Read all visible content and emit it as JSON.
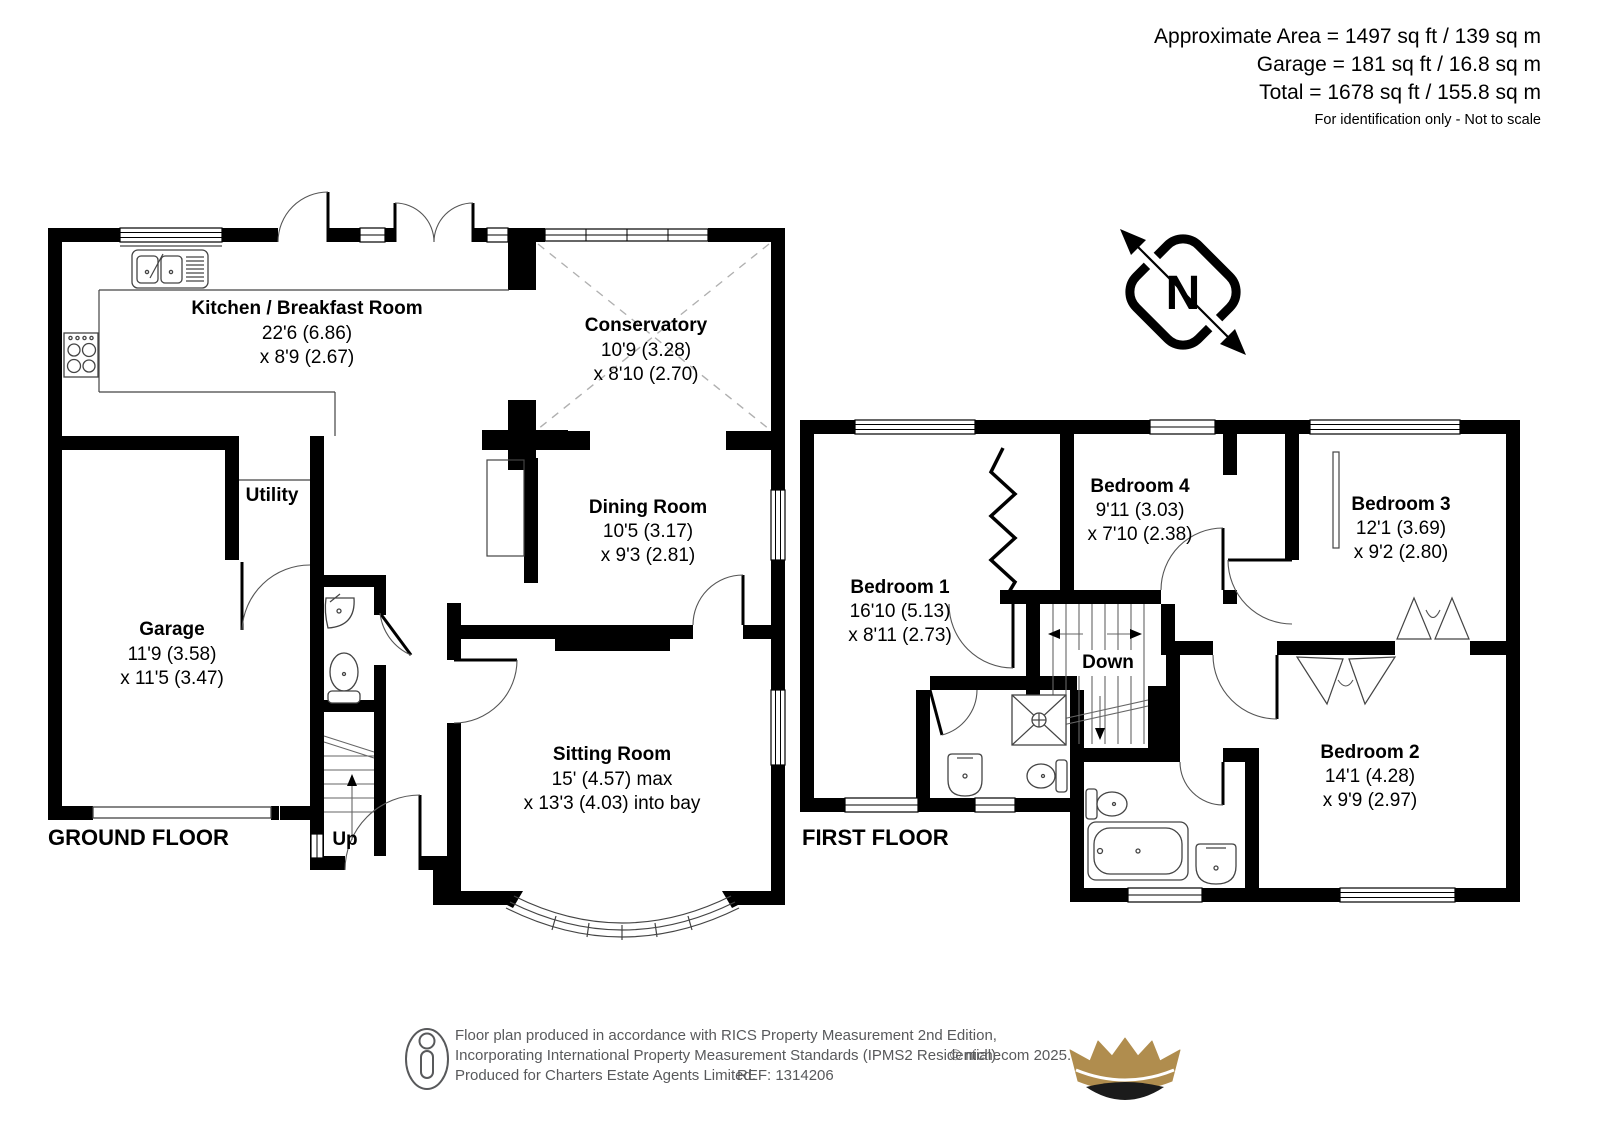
{
  "header": {
    "line1": "Approximate Area = 1497 sq ft / 139 sq m",
    "line2": "Garage = 181 sq ft / 16.8 sq m",
    "line3": "Total = 1678 sq ft / 155.8 sq m",
    "note": "For identification only - Not to scale"
  },
  "compass": {
    "label": "N"
  },
  "ground_floor": {
    "label": "GROUND FLOOR",
    "stairs_label": "Up",
    "rooms": {
      "kitchen": {
        "name": "Kitchen / Breakfast Room",
        "dim1": "22'6 (6.86)",
        "dim2": "x 8'9 (2.67)"
      },
      "conservatory": {
        "name": "Conservatory",
        "dim1": "10'9 (3.28)",
        "dim2": "x 8'10 (2.70)"
      },
      "dining_room": {
        "name": "Dining Room",
        "dim1": "10'5 (3.17)",
        "dim2": "x 9'3 (2.81)"
      },
      "sitting_room": {
        "name": "Sitting Room",
        "dim1": "15' (4.57) max",
        "dim2": "x 13'3 (4.03) into bay"
      },
      "utility": {
        "name": "Utility"
      },
      "garage": {
        "name": "Garage",
        "dim1": "11'9 (3.58)",
        "dim2": "x 11'5 (3.47)"
      }
    }
  },
  "first_floor": {
    "label": "FIRST FLOOR",
    "stairs_label": "Down",
    "rooms": {
      "bedroom1": {
        "name": "Bedroom 1",
        "dim1": "16'10 (5.13)",
        "dim2": "x 8'11 (2.73)"
      },
      "bedroom4": {
        "name": "Bedroom 4",
        "dim1": "9'11 (3.03)",
        "dim2": "x 7'10 (2.38)"
      },
      "bedroom3": {
        "name": "Bedroom 3",
        "dim1": "12'1 (3.69)",
        "dim2": "x 9'2 (2.80)"
      },
      "bedroom2": {
        "name": "Bedroom 2",
        "dim1": "14'1 (4.28)",
        "dim2": "x 9'9 (2.97)"
      }
    }
  },
  "footer": {
    "line1": "Floor plan produced in accordance with RICS Property Measurement 2nd Edition,",
    "line2": "Incorporating International Property Measurement Standards (IPMS2 Residential).",
    "line3": "Produced for Charters Estate Agents Limited.",
    "ref": "REF: 1314206",
    "copyright": "© nichecom 2025."
  },
  "colors": {
    "wall": "#000000",
    "footer_text": "#58595b",
    "crown_gold": "#b08d4e",
    "crown_dark": "#1b1b1b"
  }
}
